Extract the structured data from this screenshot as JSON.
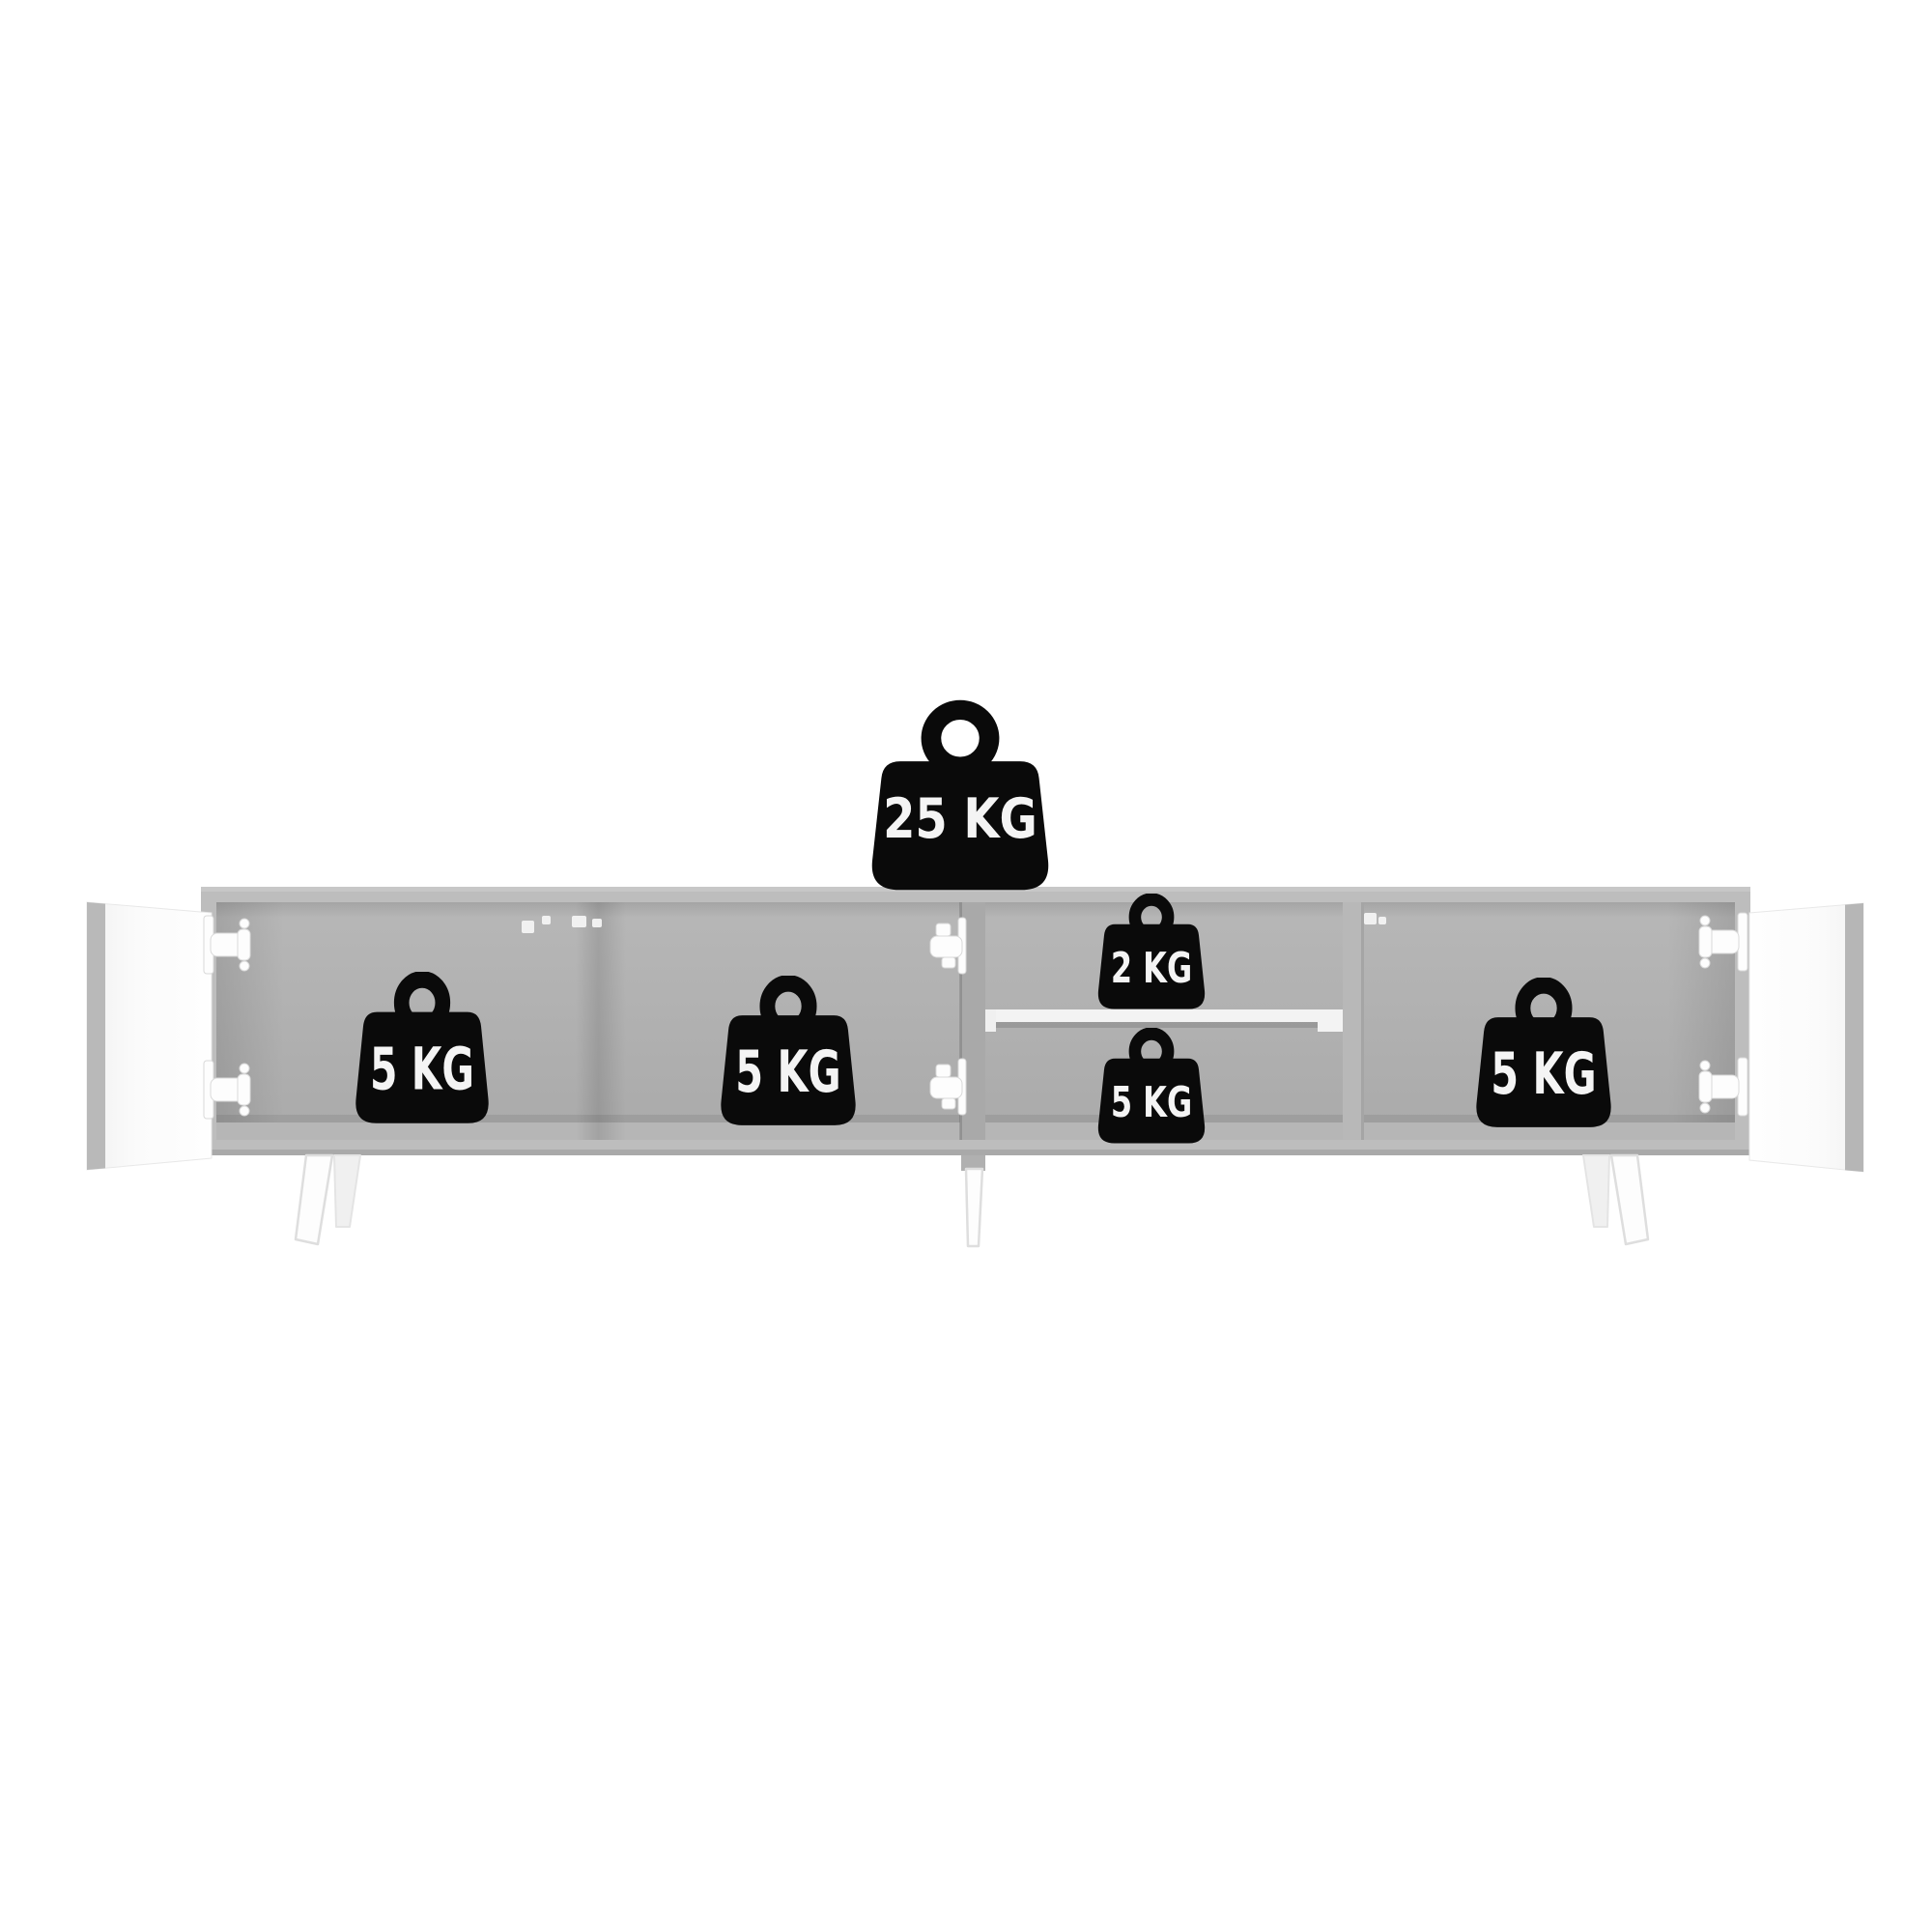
{
  "weights": {
    "top_panel": {
      "label": "25 KG"
    },
    "left_compartment": {
      "label": "5 KG"
    },
    "center_left_compartment": {
      "label": "5 KG"
    },
    "shelf_upper": {
      "label": "2 KG"
    },
    "shelf_lower": {
      "label": "5 KG"
    },
    "right_compartment": {
      "label": "5 KG"
    }
  },
  "colors": {
    "background": "#ffffff",
    "cabinet_frame": "#bdbdbd",
    "cabinet_interior": "#b2b2b2",
    "divider": "#ababab",
    "door_face": "#fafafa",
    "door_edge": "#b7b7b7",
    "shelf": "#f3f3f3",
    "hardware": "#fdfdfd",
    "weight_icon": "#0a0a0a",
    "weight_label": "#f4f4f4"
  }
}
